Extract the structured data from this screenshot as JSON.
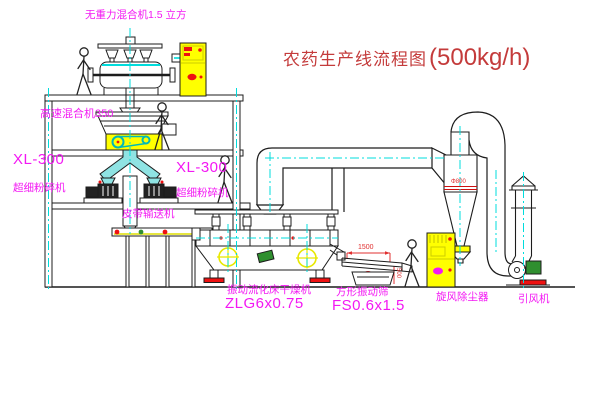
{
  "title": {
    "name": "农药生产线流程图",
    "capacity": "(500kg/h)"
  },
  "labels": {
    "gravity_mixer": "无重力混合机1.5 立方",
    "high_speed_mixer": "高速混合机350",
    "mill_left_model": "XL-300",
    "mill_left_name": "超细粉碎机",
    "mill_center_model": "XL-300",
    "mill_center_name": "超细粉碎机",
    "belt_conveyor": "皮带输送机",
    "dryer_name": "振动流化床干燥机",
    "dryer_model": "ZLG6x0.75",
    "sieve_name": "方形振动筛",
    "sieve_model": "FS0.6x1.5",
    "cyclone": "旋风除尘器",
    "fan": "引风机"
  },
  "dimensions": {
    "sieve_length": "1500",
    "sieve_height": "500",
    "cyclone_diameter": "Φ800"
  },
  "colors": {
    "line": "#1c1c1c",
    "centerline": "#00dcdc",
    "label_magenta": "#f318f3",
    "title_red": "#c43b3b",
    "highlight_yellow": "#ffff00",
    "alert_red": "#ee1111",
    "machine_green": "#2f8f2f"
  }
}
